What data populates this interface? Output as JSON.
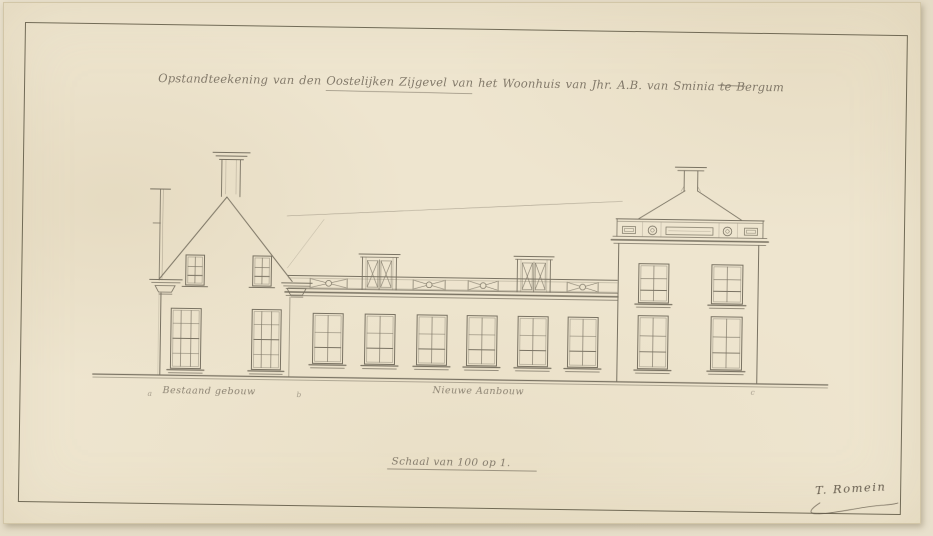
{
  "sheet": {
    "title": "Opstandteekening van den Oostelijken Zijgevel van het Woonhuis van Jhr. A.B. van Sminia te Bergum",
    "annotations": {
      "left_label": "Bestaand gebouw",
      "center_label": "Nieuwe Aanbouw",
      "scale_note": "Schaal van 100 op 1.",
      "signature": "T. Romein"
    },
    "reference_marks": [
      "a",
      "b",
      "c"
    ],
    "colors": {
      "paper": "#ece3cc",
      "background": "#e6ddc8",
      "ink": "#6f6859",
      "border": "#57503d",
      "handwriting": "#7b7263"
    }
  }
}
